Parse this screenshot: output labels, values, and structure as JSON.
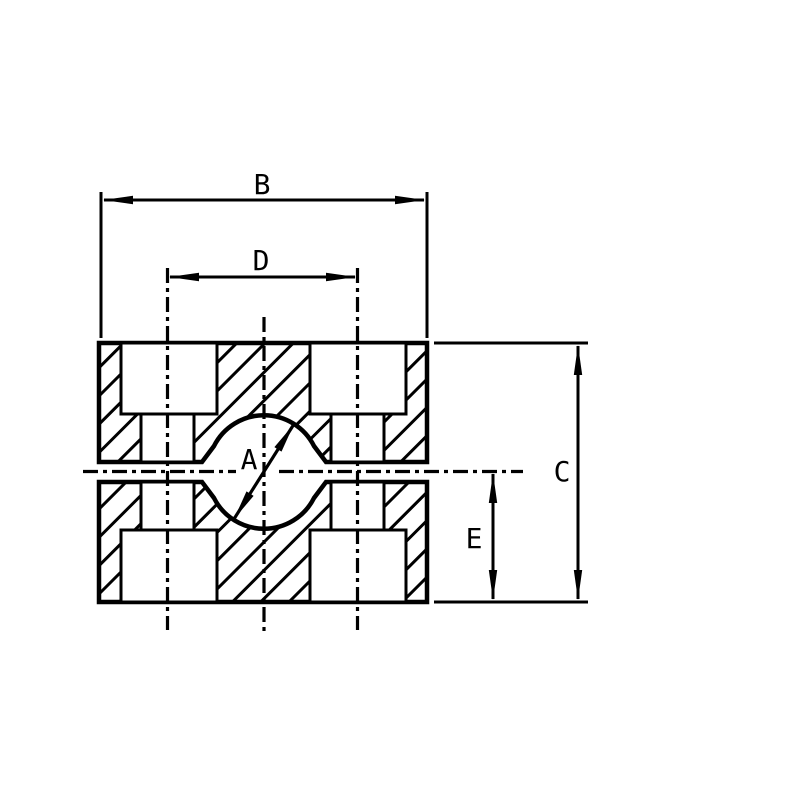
{
  "drawing": {
    "labels": {
      "bore_diameter": "A",
      "overall_width": "B",
      "overall_height": "C",
      "bolt_spacing": "D",
      "center_to_bottom": "E"
    },
    "colors": {
      "ink": "#000000",
      "background": "#ffffff"
    }
  }
}
